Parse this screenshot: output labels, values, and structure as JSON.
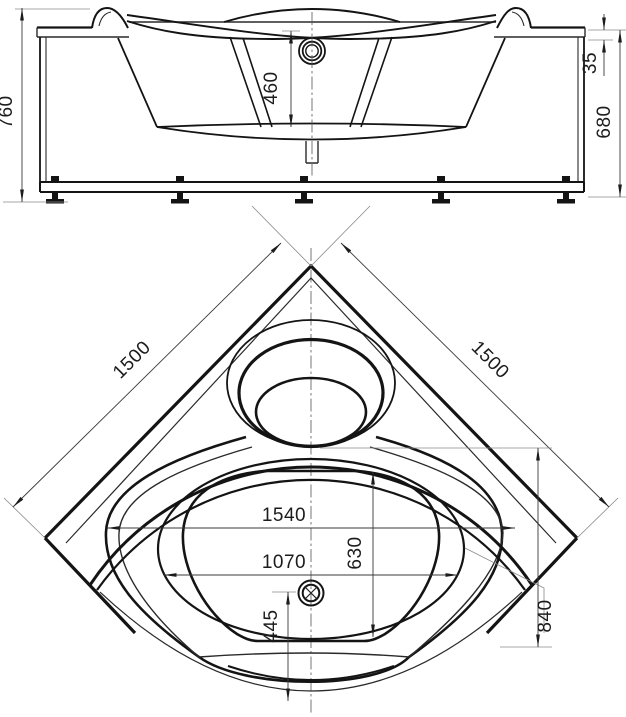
{
  "drawing": {
    "kind": "corner-bathtub-technical-drawing",
    "front_view": {
      "dims": {
        "overall_height": "760",
        "basin_depth": "460",
        "rim_offset": "35",
        "panel_height": "680"
      }
    },
    "plan_view": {
      "dims": {
        "side_left": "1500",
        "side_right": "1500",
        "overall_width": "1540",
        "basin_width": "1070",
        "basin_length": "630",
        "drain_to_edge": "445",
        "corner_to_front": "840"
      }
    }
  }
}
